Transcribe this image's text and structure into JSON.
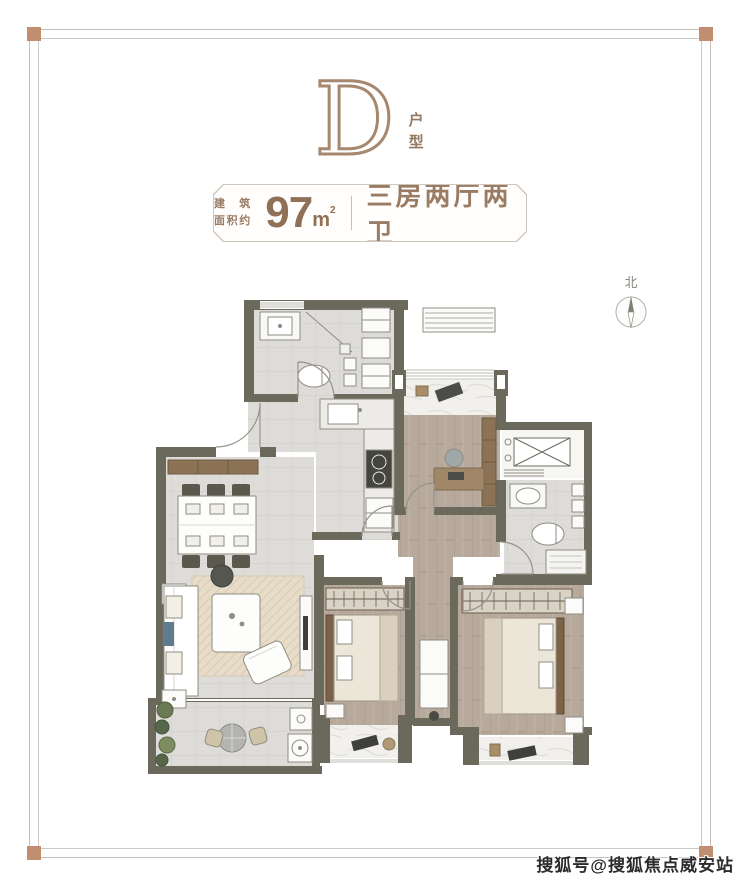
{
  "header": {
    "type_letter": "D",
    "type_suffix": "户型"
  },
  "plaque": {
    "prefix_line1": "建 筑",
    "prefix_line2": "面积约",
    "area_value": "97",
    "area_unit": "m",
    "area_unit_sup": "2",
    "layout_text": "三房两厅两卫"
  },
  "compass": {
    "label": "北"
  },
  "watermark": {
    "text": "搜狐号@搜狐焦点威安站"
  },
  "colors": {
    "frame_line": "#c6beb5",
    "frame_corner": "#c08f70",
    "heading_brown": "#a5886d",
    "plaque_text": "#9a7c64",
    "wall": "#6b695b",
    "tile_floor": "#dedcd8",
    "wood_floor": "#b7aa9d",
    "marble_floor": "#f1f0ed",
    "watermark_text": "#2b2b2b"
  }
}
